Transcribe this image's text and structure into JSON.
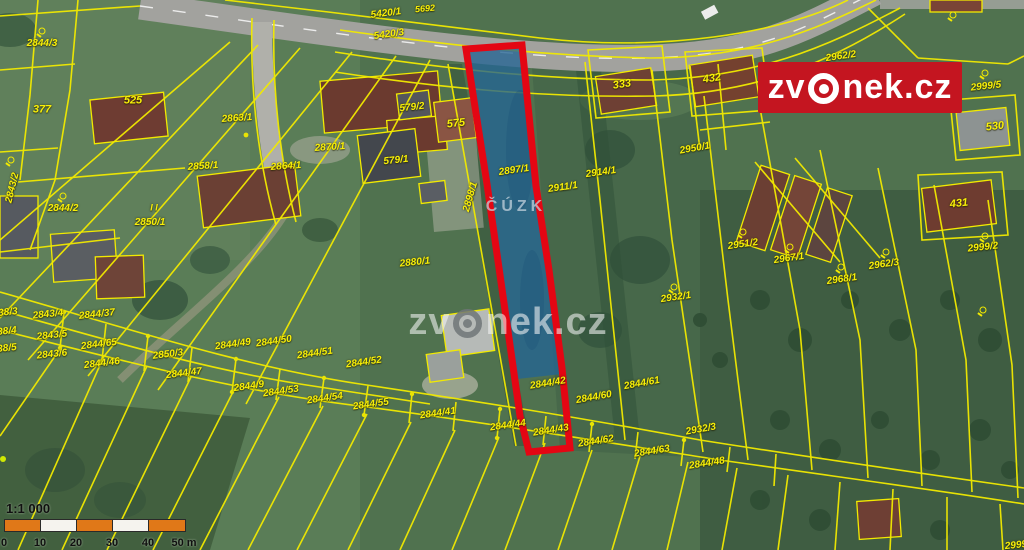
{
  "logo": {
    "left": "zv",
    "right": "nek.cz"
  },
  "watermark": {
    "left": "zv",
    "right": "nek.cz",
    "cuzk": "ČÚZK"
  },
  "scale": {
    "ratio": "1:1 000",
    "ticks": [
      "0",
      "10",
      "20",
      "30",
      "40",
      "50 m"
    ]
  },
  "highlight": {
    "parcel": "2897/1",
    "outline_color": "#e40613",
    "fill_color": "#246494"
  },
  "colors": {
    "boundary_line": "#f2ea00",
    "label": "#f8ef08",
    "logo_red": "#c41520",
    "scale_orange": "#e07818"
  },
  "parcel_labels": [
    {
      "t": "5692",
      "x": 425,
      "y": 9,
      "r": -5,
      "s": 9
    },
    {
      "t": "5420/1",
      "x": 386,
      "y": 14,
      "r": -7
    },
    {
      "t": "5420/3",
      "x": 389,
      "y": 35,
      "r": -8
    },
    {
      "t": "2844/3",
      "x": 42,
      "y": 44,
      "r": 0
    },
    {
      "t": "377",
      "x": 42,
      "y": 110,
      "r": 0,
      "s": 11
    },
    {
      "t": "525",
      "x": 133,
      "y": 101,
      "r": 0,
      "s": 11
    },
    {
      "t": "2863/1",
      "x": 237,
      "y": 119,
      "r": -4
    },
    {
      "t": "2858/1",
      "x": 203,
      "y": 167,
      "r": -4
    },
    {
      "t": "2864/1",
      "x": 286,
      "y": 167,
      "r": -4
    },
    {
      "t": "2870/1",
      "x": 330,
      "y": 148,
      "r": -4
    },
    {
      "t": "579/2",
      "x": 412,
      "y": 108,
      "r": -6
    },
    {
      "t": "575",
      "x": 456,
      "y": 124,
      "r": -6,
      "s": 11
    },
    {
      "t": "579/1",
      "x": 396,
      "y": 161,
      "r": -6
    },
    {
      "t": "333",
      "x": 622,
      "y": 85,
      "r": -8,
      "s": 11
    },
    {
      "t": "432",
      "x": 712,
      "y": 79,
      "r": -8,
      "s": 11
    },
    {
      "t": "2962/2",
      "x": 841,
      "y": 57,
      "r": -8
    },
    {
      "t": "2999/5",
      "x": 986,
      "y": 87,
      "r": -6
    },
    {
      "t": "530",
      "x": 995,
      "y": 127,
      "r": -6,
      "s": 11
    },
    {
      "t": "2897/1",
      "x": 514,
      "y": 171,
      "r": -8
    },
    {
      "t": "2911/1",
      "x": 563,
      "y": 188,
      "r": -8
    },
    {
      "t": "2914/1",
      "x": 601,
      "y": 173,
      "r": -8
    },
    {
      "t": "2950/1",
      "x": 695,
      "y": 149,
      "r": -10
    },
    {
      "t": "2843/2",
      "x": 13,
      "y": 188,
      "r": -76
    },
    {
      "t": "2844/2",
      "x": 63,
      "y": 209,
      "r": 0
    },
    {
      "t": "2850/1",
      "x": 150,
      "y": 223,
      "r": 0
    },
    {
      "t": "I I",
      "x": 154,
      "y": 208,
      "r": 0,
      "s": 9
    },
    {
      "t": "2898/1",
      "x": 471,
      "y": 197,
      "r": -74
    },
    {
      "t": "2880/1",
      "x": 415,
      "y": 263,
      "r": -6
    },
    {
      "t": "2951/2",
      "x": 743,
      "y": 245,
      "r": -8
    },
    {
      "t": "2967/1",
      "x": 789,
      "y": 259,
      "r": -8
    },
    {
      "t": "2968/1",
      "x": 842,
      "y": 280,
      "r": -8
    },
    {
      "t": "2962/3",
      "x": 884,
      "y": 265,
      "r": -8
    },
    {
      "t": "431",
      "x": 959,
      "y": 204,
      "r": -6,
      "s": 11
    },
    {
      "t": "2999/2",
      "x": 983,
      "y": 248,
      "r": -6
    },
    {
      "t": "2932/1",
      "x": 676,
      "y": 298,
      "r": -8
    },
    {
      "t": "38/3",
      "x": 8,
      "y": 313,
      "r": -6
    },
    {
      "t": "2843/4",
      "x": 48,
      "y": 315,
      "r": -6
    },
    {
      "t": "2844/37",
      "x": 97,
      "y": 315,
      "r": -6
    },
    {
      "t": "38/4",
      "x": 7,
      "y": 332,
      "r": -6
    },
    {
      "t": "2843/5",
      "x": 52,
      "y": 336,
      "r": -6
    },
    {
      "t": "2844/65",
      "x": 99,
      "y": 345,
      "r": -7
    },
    {
      "t": "38/5",
      "x": 7,
      "y": 349,
      "r": -6
    },
    {
      "t": "2843/6",
      "x": 52,
      "y": 355,
      "r": -6
    },
    {
      "t": "2844/46",
      "x": 102,
      "y": 364,
      "r": -7
    },
    {
      "t": "2850/3",
      "x": 168,
      "y": 355,
      "r": -7
    },
    {
      "t": "2844/49",
      "x": 233,
      "y": 345,
      "r": -8
    },
    {
      "t": "2844/50",
      "x": 274,
      "y": 342,
      "r": -8
    },
    {
      "t": "2844/51",
      "x": 315,
      "y": 354,
      "r": -8
    },
    {
      "t": "2844/52",
      "x": 364,
      "y": 363,
      "r": -8
    },
    {
      "t": "2844/47",
      "x": 184,
      "y": 374,
      "r": -7
    },
    {
      "t": "2844/9",
      "x": 249,
      "y": 387,
      "r": -8
    },
    {
      "t": "2844/53",
      "x": 281,
      "y": 392,
      "r": -8
    },
    {
      "t": "2844/54",
      "x": 325,
      "y": 399,
      "r": -8
    },
    {
      "t": "2844/55",
      "x": 371,
      "y": 405,
      "r": -8
    },
    {
      "t": "2844/41",
      "x": 438,
      "y": 414,
      "r": -8
    },
    {
      "t": "2844/44",
      "x": 508,
      "y": 426,
      "r": -8
    },
    {
      "t": "2844/42",
      "x": 548,
      "y": 384,
      "r": -9
    },
    {
      "t": "2844/43",
      "x": 551,
      "y": 431,
      "r": -9
    },
    {
      "t": "2844/60",
      "x": 594,
      "y": 398,
      "r": -10
    },
    {
      "t": "2844/61",
      "x": 642,
      "y": 384,
      "r": -10
    },
    {
      "t": "2932/3",
      "x": 701,
      "y": 430,
      "r": -10
    },
    {
      "t": "2844/62",
      "x": 596,
      "y": 442,
      "r": -9
    },
    {
      "t": "2844/63",
      "x": 652,
      "y": 452,
      "r": -9
    },
    {
      "t": "2844/48",
      "x": 707,
      "y": 464,
      "r": -9
    },
    {
      "t": "2999",
      "x": 1016,
      "y": 546,
      "r": -6
    }
  ],
  "symbols": [
    {
      "x": 42,
      "y": 31
    },
    {
      "x": 11,
      "y": 160
    },
    {
      "x": 63,
      "y": 196
    },
    {
      "x": 953,
      "y": 15
    },
    {
      "x": 985,
      "y": 73
    },
    {
      "x": 743,
      "y": 232
    },
    {
      "x": 790,
      "y": 247
    },
    {
      "x": 841,
      "y": 267
    },
    {
      "x": 886,
      "y": 252
    },
    {
      "x": 985,
      "y": 236
    },
    {
      "x": 983,
      "y": 310
    },
    {
      "x": 674,
      "y": 287
    }
  ]
}
